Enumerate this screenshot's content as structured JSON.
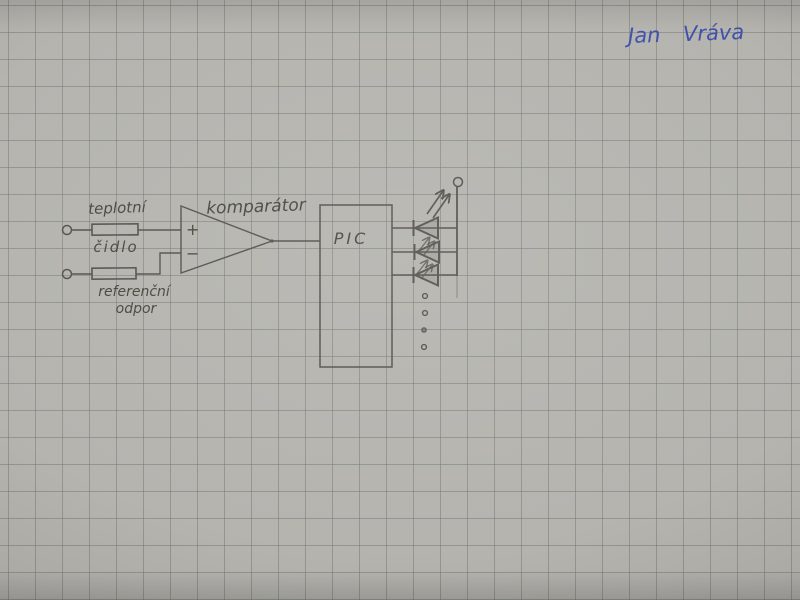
{
  "photo": {
    "signature": "Jan Vráva"
  },
  "diagram": {
    "labels": {
      "sensor_line1": "teplotní",
      "sensor_line2": "čidlo",
      "reference_line1": "referenční",
      "reference_line2": "odpor",
      "comparator": "komparátor",
      "mcu": "PIC",
      "plus_input": "+",
      "minus_input": "−"
    },
    "led_array": {
      "visible_led_symbols": 3,
      "ellipsis_dots": 4
    },
    "colors": {
      "paper": "#b5b4af",
      "grid_line": "#9a9995",
      "pencil": "#55544e",
      "ink_blue": "#3f51ad"
    }
  }
}
